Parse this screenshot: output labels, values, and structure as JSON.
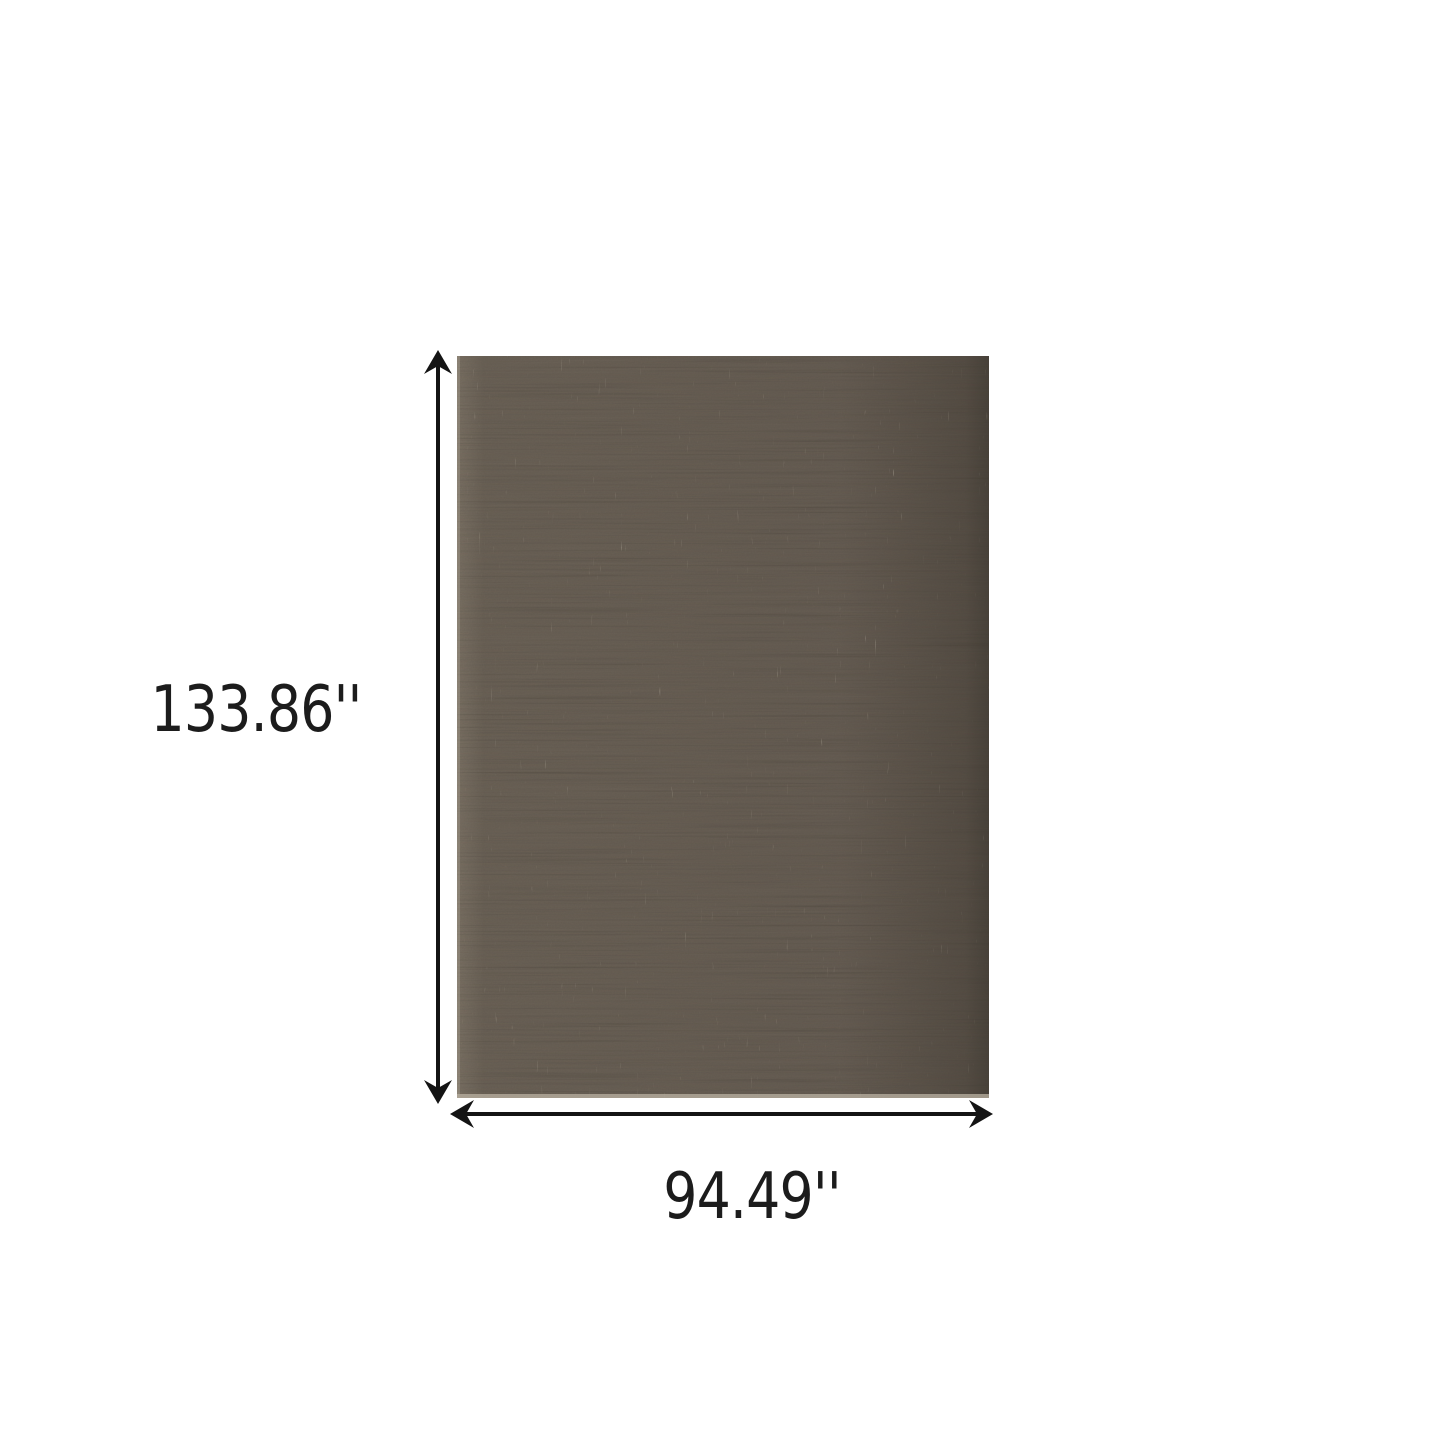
{
  "diagram": {
    "height_label": "133.86''",
    "width_label": "94.49''",
    "colors": {
      "background": "#ffffff",
      "arrow": "#141414",
      "text": "#1c1c1c",
      "rug_base": "#6d6459",
      "rug_base_light": "#7d7467",
      "rug_base_mid": "#685f55",
      "rug_shadow_right": "#4a443c",
      "rug_streak_dark": "#3c362e",
      "rug_fleck_light": "#d8d1c1",
      "rug_edge_fringe": "#b5ad9e"
    }
  }
}
